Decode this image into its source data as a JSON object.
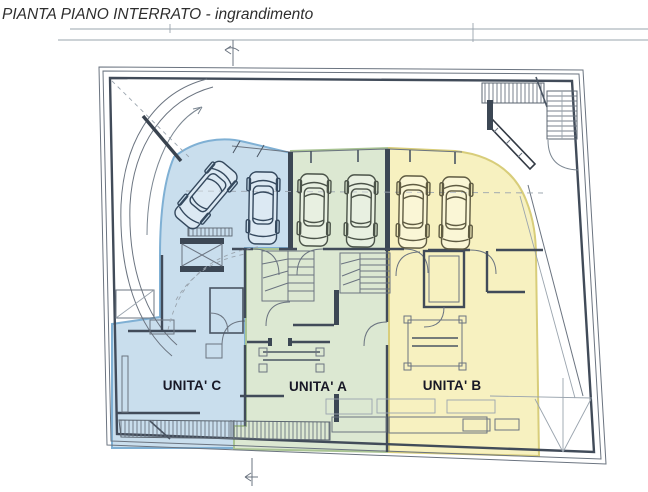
{
  "header": {
    "title": "PIANTA PIANO INTERRATO - ingrandimento"
  },
  "units": [
    {
      "label": "UNITA' C",
      "fill": "#94bedc",
      "region_color_name": "blue"
    },
    {
      "label": "UNITA' A",
      "fill": "#bad2a5",
      "region_color_name": "green"
    },
    {
      "label": "UNITA' B",
      "fill": "#f2e896",
      "region_color_name": "yellow"
    }
  ],
  "plan": {
    "cars_total": 6,
    "cars_unit_c": 2,
    "cars_unit_a": 2,
    "cars_unit_b": 2
  },
  "colors": {
    "wall": "#414b59",
    "line": "#6b7480",
    "background": "#ffffff"
  }
}
